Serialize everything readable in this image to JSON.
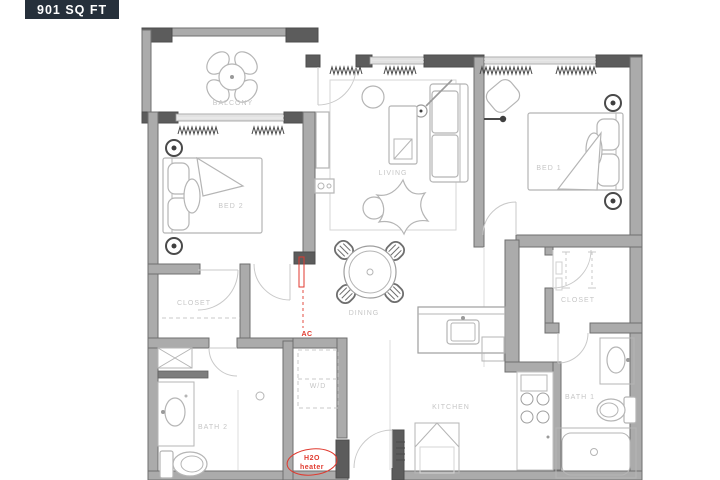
{
  "header": {
    "area_label": "901 SQ FT"
  },
  "rooms": {
    "balcony": {
      "label": "BALCONY"
    },
    "living": {
      "label": "LIVING"
    },
    "dining": {
      "label": "DINING"
    },
    "kitchen": {
      "label": "KITCHEN"
    },
    "bed1": {
      "label": "BED 1"
    },
    "bed2": {
      "label": "BED 2"
    },
    "closet_bed1": {
      "label": "CLOSET"
    },
    "closet_bed2": {
      "label": "CLOSET"
    },
    "bath1": {
      "label": "BATH 1"
    },
    "bath2": {
      "label": "BATH 2"
    },
    "laundry": {
      "label": "W/D"
    }
  },
  "annotations": {
    "ac": {
      "label": "AC"
    },
    "water_heater": {
      "line1": "H2O",
      "line2": "heater"
    }
  },
  "colors": {
    "header_bg": "#26303b",
    "header_text": "#ffffff",
    "wall_fill": "#ababab",
    "wall_edge": "#6f6f6f",
    "wall_dark": "#5c5c5c",
    "furniture": "#b5b5b5",
    "label_text": "#c6c6c6",
    "accent_red": "#e03a2f"
  }
}
